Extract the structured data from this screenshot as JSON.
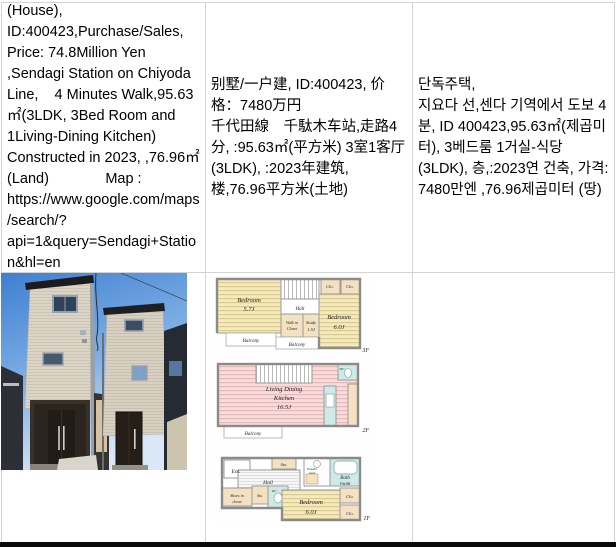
{
  "listing": {
    "en": "(House), ID:400423,Purchase/Sales, Price: 74.8Million Yen ,Sendagi Station on Chiyoda Line,    4 Minutes Walk,95.63㎡(3LDK, 3Bed Room and 1Living-Dining Kitchen) Constructed in 2023, ,76.96㎡ (Land)              Map : https://www.google.com/maps/search/?api=1&query=Sendagi+Station&hl=en",
    "zh": "别墅/一户建, ID:400423, 价格：7480万円\n千代田線　千駄木车站,走路4分, :95.63㎡(平方米) 3室1客厅(3LDK), :2023年建筑, \n楼,76.96平方米(土地)",
    "ko": "단독주택,\n지요다 선,센다 기역에서 도보 4분, ID 400423,95.63㎡(제곱미터), 3베드룸 1거실-식당 (3LDK), 층,:2023연 건축, 가격: 7480만엔 ,76.96제곱미터 (땅)"
  },
  "floorplan": {
    "f3": {
      "bedroom1": "Bedroom",
      "bedroom1_size": "5.7J",
      "hall": "Hall",
      "clo1": "Clo.",
      "clo2": "Clo.",
      "wic1": "Walk in",
      "wic2": "Closet",
      "study": "Study",
      "study_size": "1.5J",
      "bedroom2": "Bedroom",
      "bedroom2_size": "6.0J",
      "balcony1": "Balcony",
      "balcony2": "Balcony",
      "floor": "3F"
    },
    "f2": {
      "ldk1": "Living Dining",
      "ldk2": "Kitchen",
      "ldk3": "16.5J",
      "wc": "WC",
      "balcony": "Balcony",
      "floor": "2F"
    },
    "f1": {
      "ent": "Ent.",
      "hall": "Hall",
      "sto1": "Sto.",
      "sto2": "Sto.",
      "shoes1": "Shoes in",
      "shoes2": "closet",
      "wc": "WC",
      "powder1": "Powder",
      "powder2": "room",
      "bath1": "Bath",
      "bath2": "room",
      "bedroom": "Bedroom",
      "bedroom_size": "6.0J",
      "clo1": "Clo.",
      "clo2": "Clo.",
      "floor": "1F"
    }
  }
}
